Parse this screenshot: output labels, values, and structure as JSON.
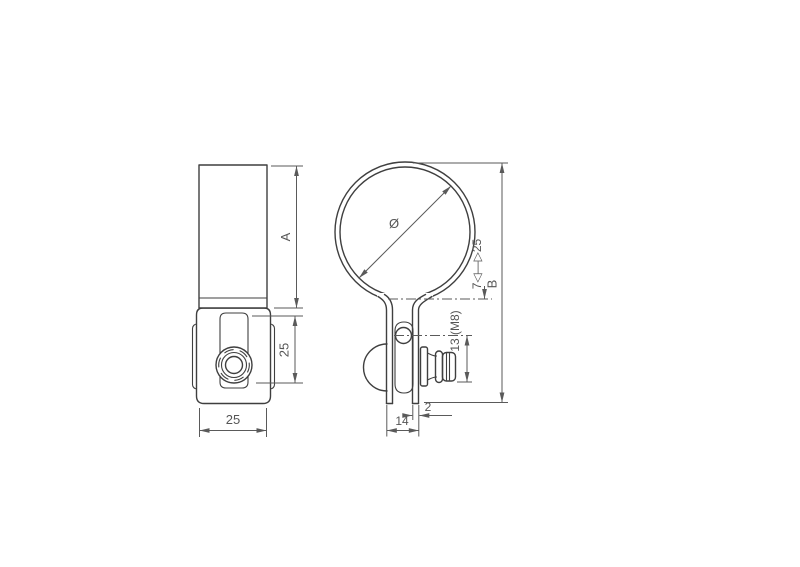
{
  "drawing": {
    "type": "technical-drawing",
    "colors": {
      "background": "#ffffff",
      "object_line": "#3f3f3f",
      "dimension_line": "#5a5a5a",
      "dimension_text": "#555555"
    },
    "front_view": {
      "dim_body_height": "A",
      "dim_clamp_height": "25",
      "dim_body_width": "25"
    },
    "side_view": {
      "dim_diameter_symbol": "Ø",
      "dim_clamp_range": "7◁—▷25",
      "dim_overall_height": "B",
      "dim_bolt": "13 (M8)",
      "dim_thickness": "2",
      "dim_leg_span": "14"
    }
  }
}
